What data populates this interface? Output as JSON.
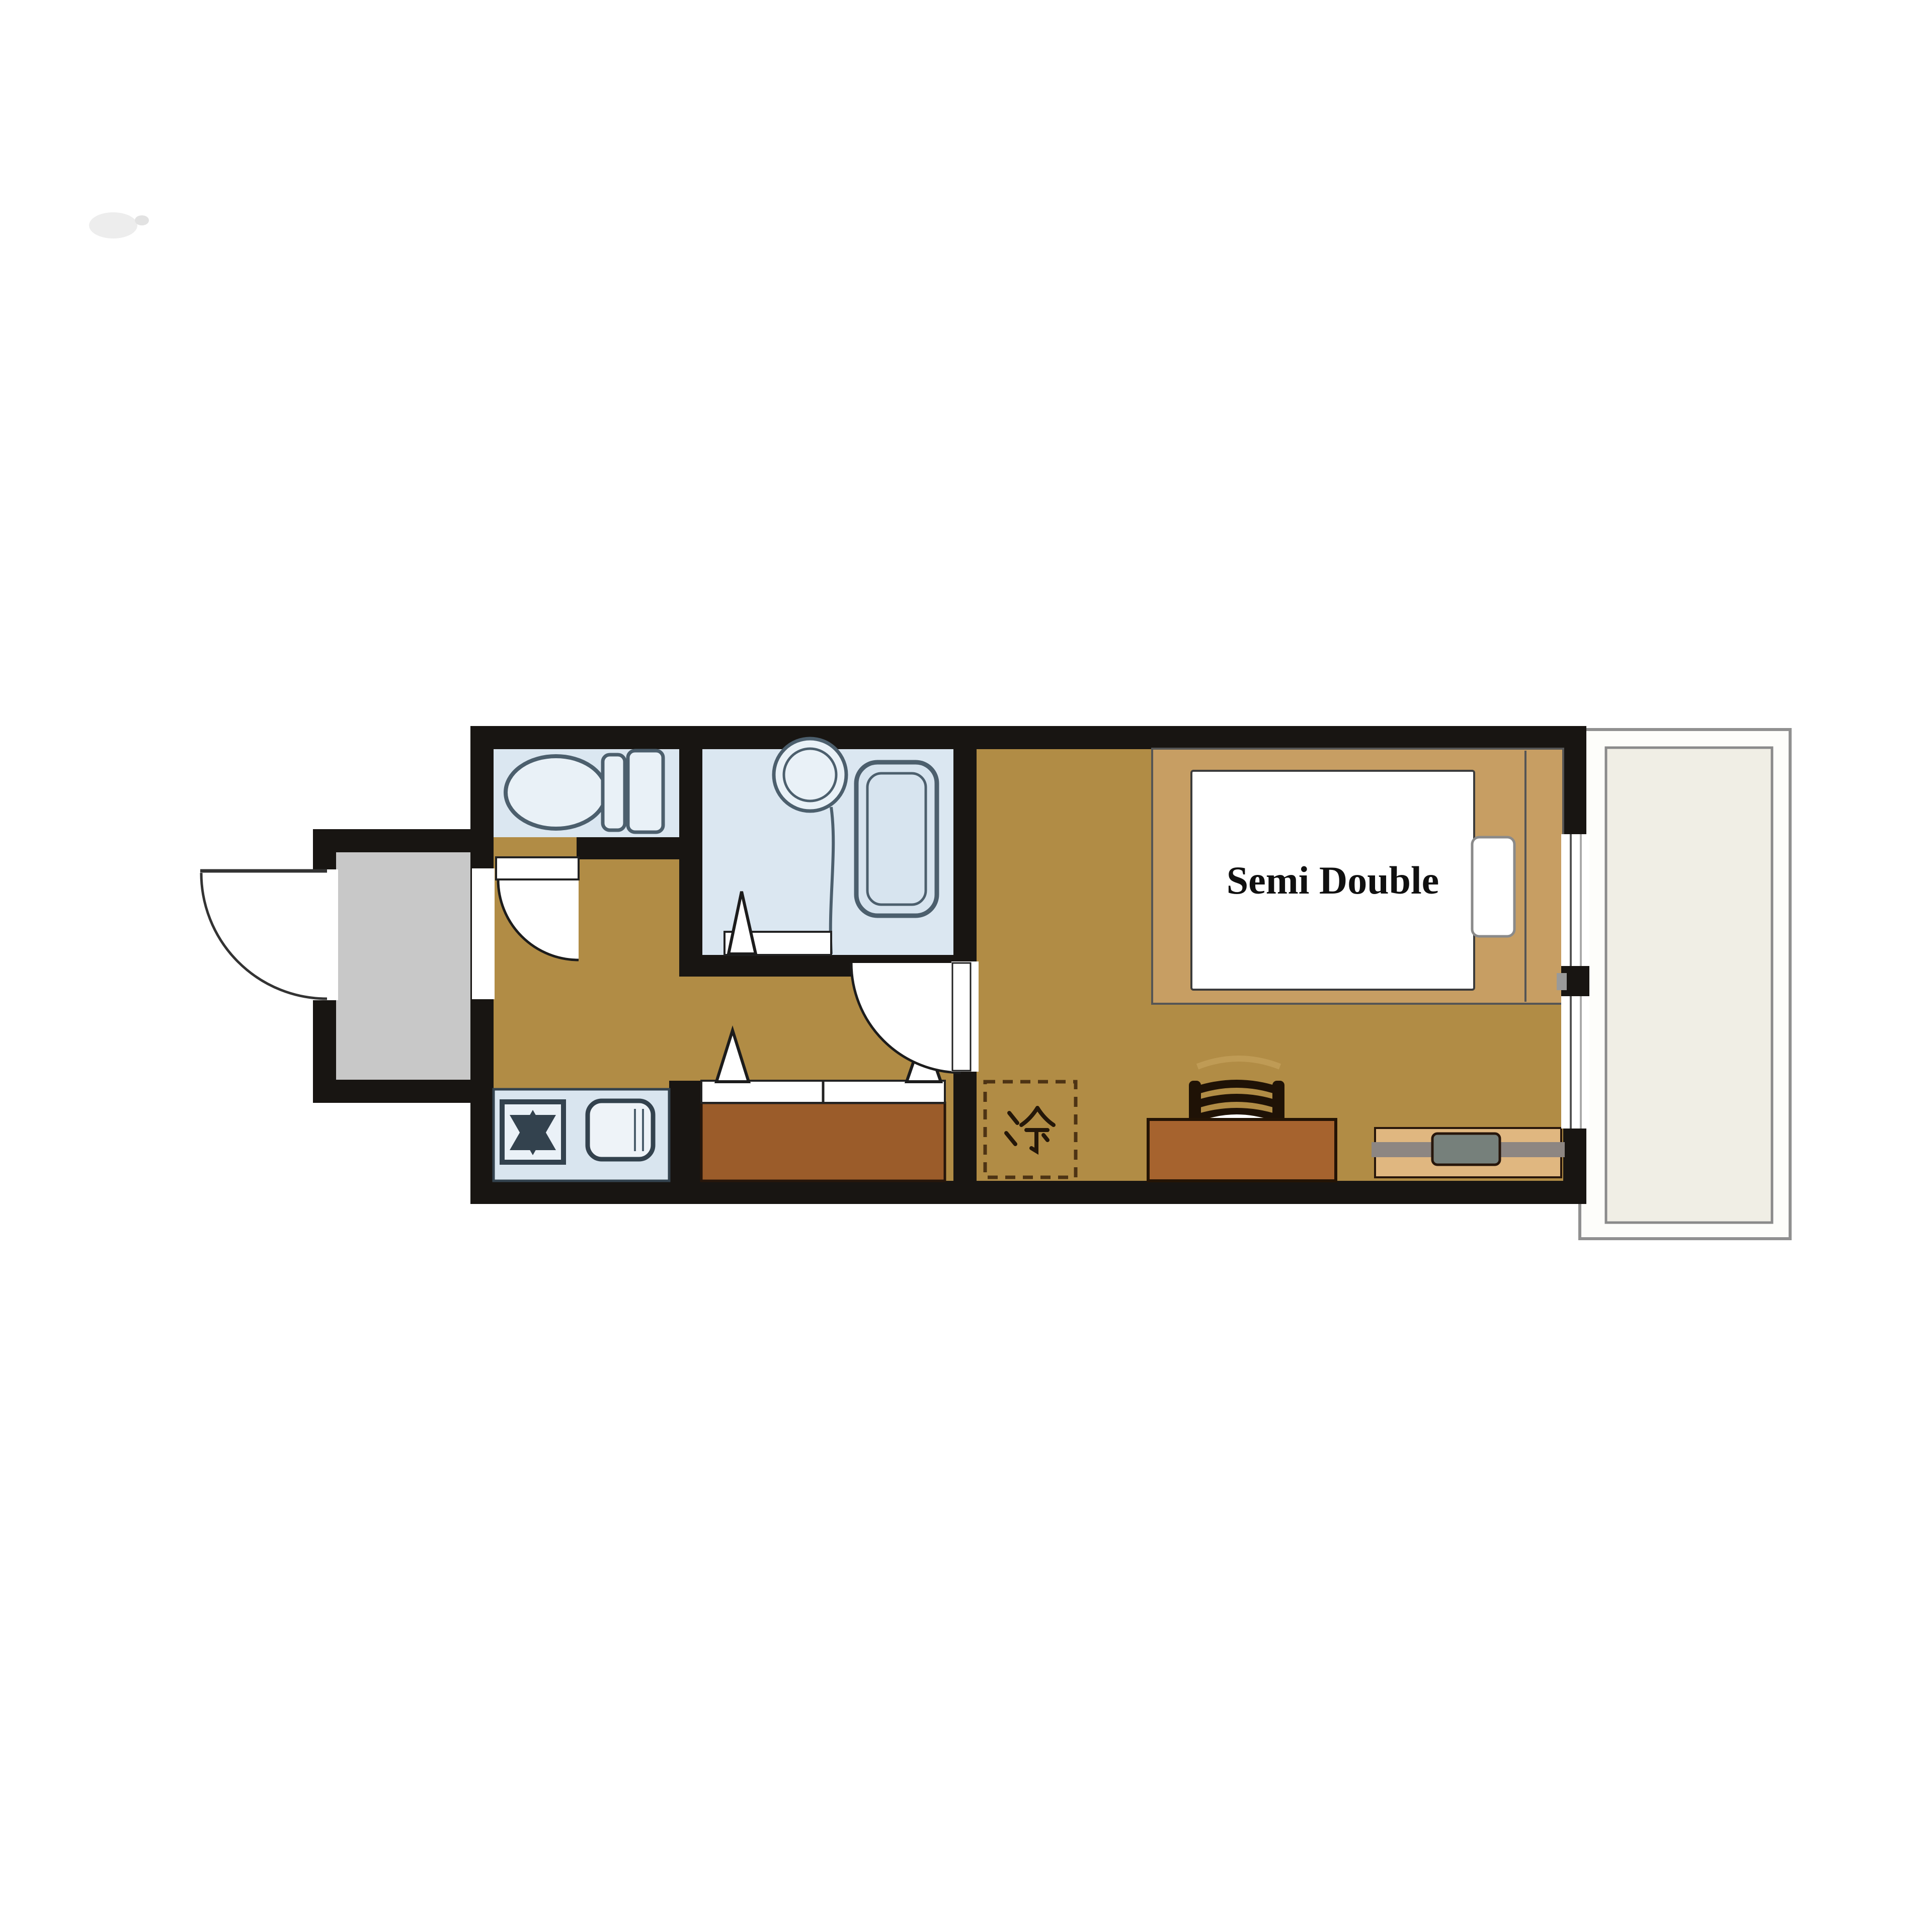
{
  "labels": {
    "bed": "Semi Double",
    "fridge": "冷"
  },
  "palette": {
    "wall": "#181512",
    "wood_floor": "#b18c45",
    "wet_room_floor": "#dbe7f1",
    "fixture_fill": "#e9f1f7",
    "fixture_stroke": "#4c5f6d",
    "entrance_gray": "#c8c8c8",
    "balcony_fill": "#f0eee5",
    "balcony_stroke": "#909090",
    "closet_brown": "#9b5c2a",
    "desk_brown": "#a6632e",
    "bed_frame_tan": "#c79e63",
    "mattress_white": "#ffffff",
    "tv_board_tan": "#e0b780",
    "tv_bar_gray": "#8d8682",
    "tv_gray": "#76807b",
    "fridge_dash_brown": "#4d3314",
    "door_line": "#1c1c1c"
  },
  "icons": [
    "toilet-icon",
    "washbasin-icon",
    "bathtub-icon",
    "stove-burner-icon",
    "kitchen-sink-icon",
    "door-swing-arc",
    "folding-door-marker",
    "bed-with-pillow",
    "desk-chair-icon",
    "tv-on-board-icon",
    "refrigerator-slot-kanji",
    "sliding-window",
    "balcony"
  ]
}
